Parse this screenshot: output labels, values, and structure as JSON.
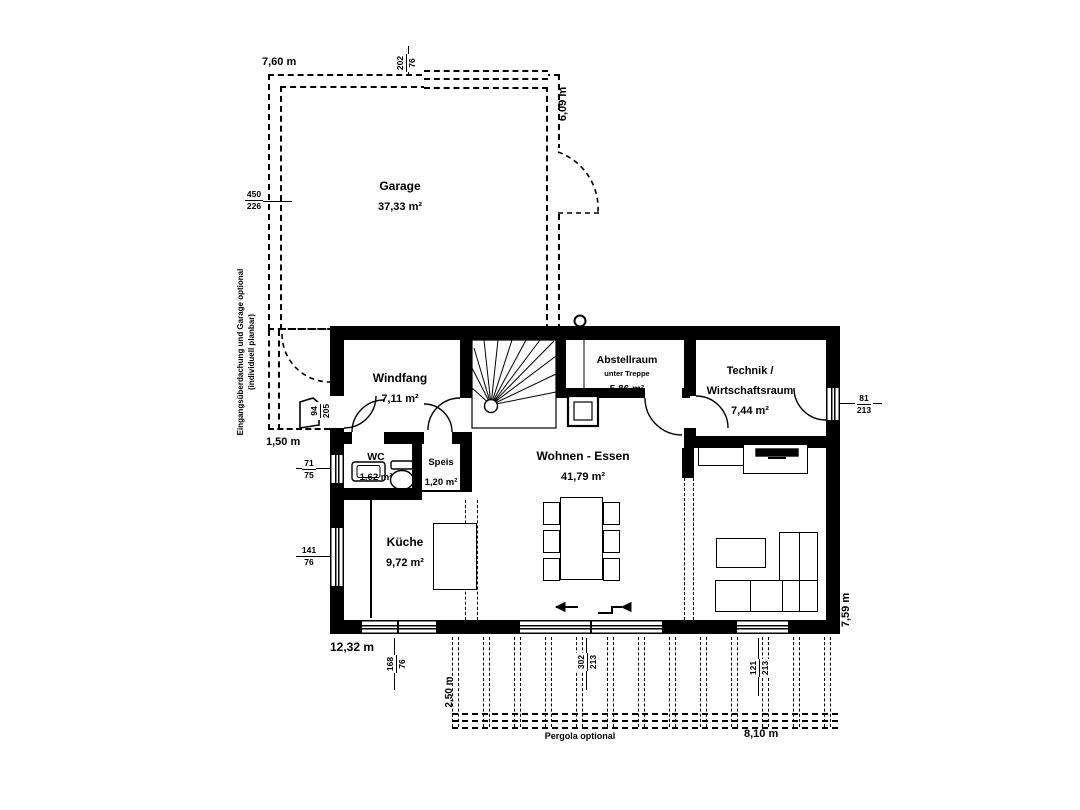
{
  "garage": {
    "name": "Garage",
    "area": "37,33 m²",
    "dim_width": "7,60 m",
    "dim_depth": "6,09 m",
    "window": {
      "w": "202",
      "h": "76"
    },
    "door": {
      "w": "450",
      "h": "226"
    }
  },
  "entry": {
    "note1": "Eingangsüberdachung und Garage optional",
    "note2": "(individuell planbar)",
    "dim_width": "1,50 m",
    "door": {
      "w": "94",
      "h": "205"
    }
  },
  "rooms": {
    "windfang": {
      "name": "Windfang",
      "area": "7,11 m²"
    },
    "abstellraum": {
      "name": "Abstellraum",
      "sub": "unter Treppe",
      "area": "5,86 m²"
    },
    "technik": {
      "name1": "Technik /",
      "name2": "Wirtschaftsraum",
      "area": "7,44 m²"
    },
    "wc": {
      "name": "WC",
      "area": "1,62 m²"
    },
    "speis": {
      "name": "Speis",
      "area": "1,20 m²"
    },
    "kueche": {
      "name": "Küche",
      "area": "9,72 m²"
    },
    "wohnen": {
      "name": "Wohnen - Essen",
      "area": "41,79 m²"
    }
  },
  "openings": {
    "wc_window": {
      "w": "71",
      "h": "75"
    },
    "kueche_window": {
      "w": "141",
      "h": "76"
    },
    "technik_door": {
      "w": "81",
      "h": "213"
    },
    "bottom_window": {
      "w": "168",
      "h": "76"
    },
    "terrace_door": {
      "w": "302",
      "h": "213"
    },
    "living_window": {
      "w": "121",
      "h": "213"
    }
  },
  "dims": {
    "house_width": "12,32 m",
    "house_depth": "7,59 m",
    "pergola_label": "Pergola optional",
    "pergola_width": "8,10 m",
    "pergola_depth": "2,50 m"
  }
}
